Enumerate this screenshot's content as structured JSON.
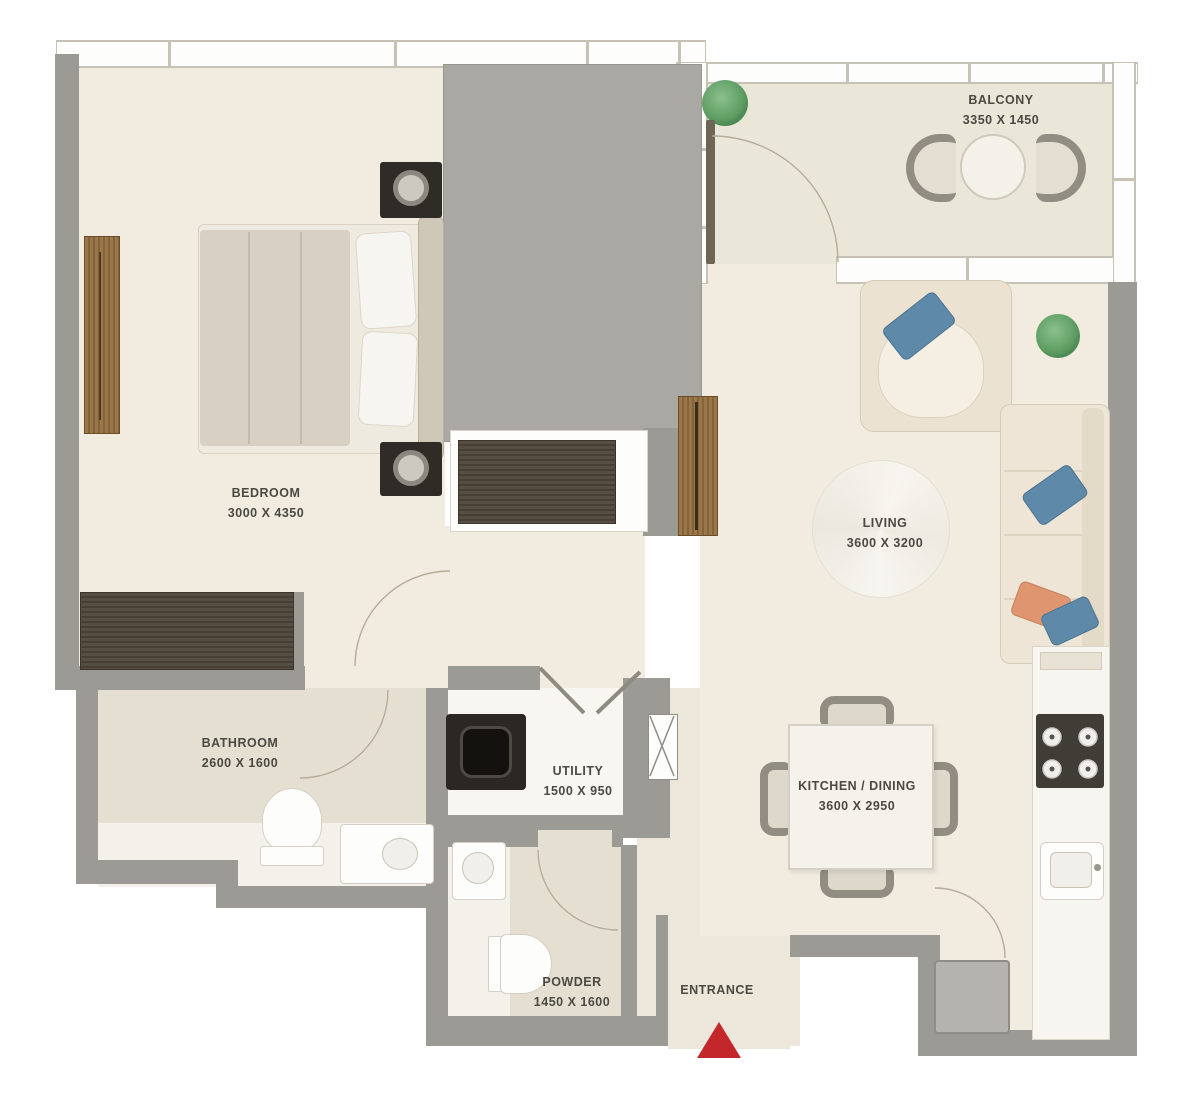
{
  "title": "One-bedroom apartment floor plan",
  "rooms": [
    {
      "name": "BEDROOM",
      "dims": "3000 X 4350"
    },
    {
      "name": "BALCONY",
      "dims": "3350 X 1450"
    },
    {
      "name": "LIVING",
      "dims": "3600 X 3200"
    },
    {
      "name": "KITCHEN / DINING",
      "dims": "3600 X 2950"
    },
    {
      "name": "BATHROOM",
      "dims": "2600 X 1600"
    },
    {
      "name": "UTILITY",
      "dims": "1500 X 950"
    },
    {
      "name": "POWDER",
      "dims": "1450 X 1600"
    },
    {
      "name": "ENTRANCE",
      "dims": ""
    }
  ],
  "palette": {
    "wall_gray": "#9b9a94",
    "shaft_gray": "#a9a8a2",
    "floor_cream": "#f1ecdf",
    "floor_beige": "#e5dfd1",
    "balcony_floor": "#eae7d8",
    "wood_dark": "#55493c",
    "wood_medium": "#96713f",
    "accent_blue": "#5e89a8",
    "accent_orange": "#df9670",
    "plant_green": "#5f9e63",
    "entrance_marker_red": "#c4272b",
    "label_text": "#4b4943"
  }
}
